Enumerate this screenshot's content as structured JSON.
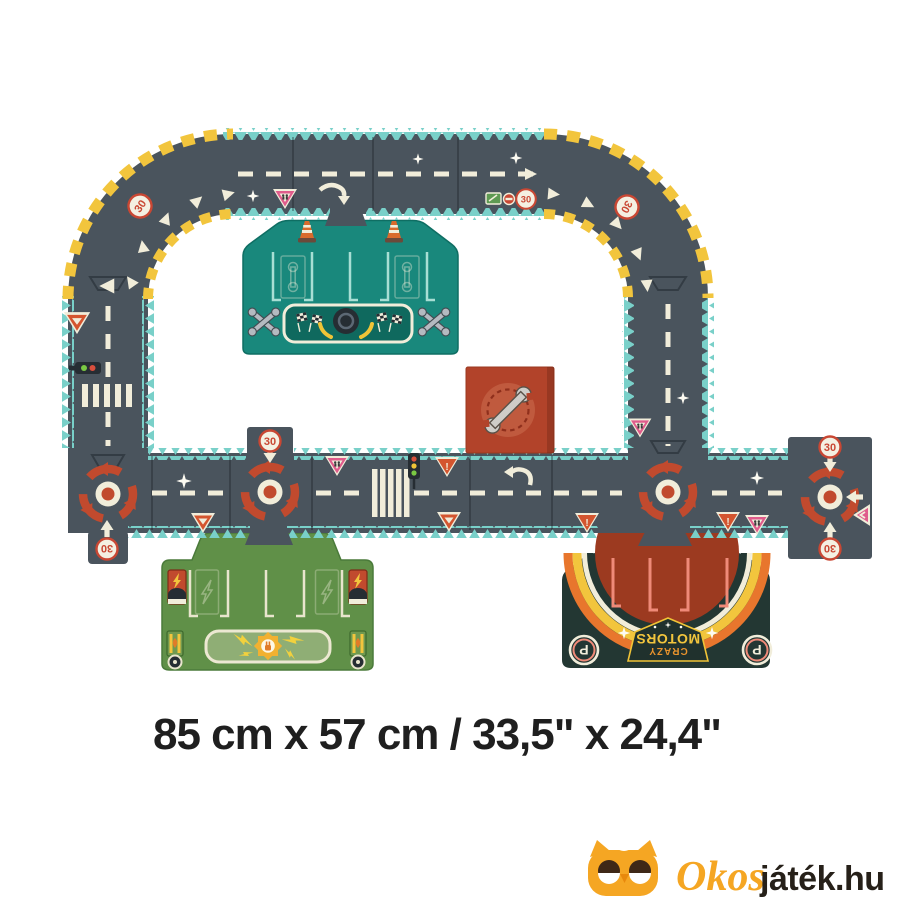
{
  "footer": {
    "dimensions": "85 cm x 57 cm / 33,5\" x 24,4\""
  },
  "mat_graphics": {
    "speed_limit": "30",
    "parking_letter": "P",
    "brand_line1": "CRAZY",
    "brand_line2": "MOTORS",
    "warning_mark": "!"
  },
  "watermark": {
    "brand_prefix": "Okos",
    "brand_suffix": "játék.hu"
  },
  "colors": {
    "background": "#ffffff",
    "road": "#4a545d",
    "puzzle_edge_teal": "#79d0c9",
    "hazard_yellow": "#f2c53d",
    "road_marking_cream": "#f1edda",
    "traffic_red": "#c94733",
    "pink_sign": "#e05c8c",
    "pit_mat_teal": "#19887c",
    "charging_mat_green": "#609048",
    "parking_mat_dark": "#233733",
    "parking_dome_red": "#9c3a20",
    "repair_tile_red": "#b2432a",
    "logo_orange": "#f5a623",
    "logo_text_dark": "#262019"
  }
}
